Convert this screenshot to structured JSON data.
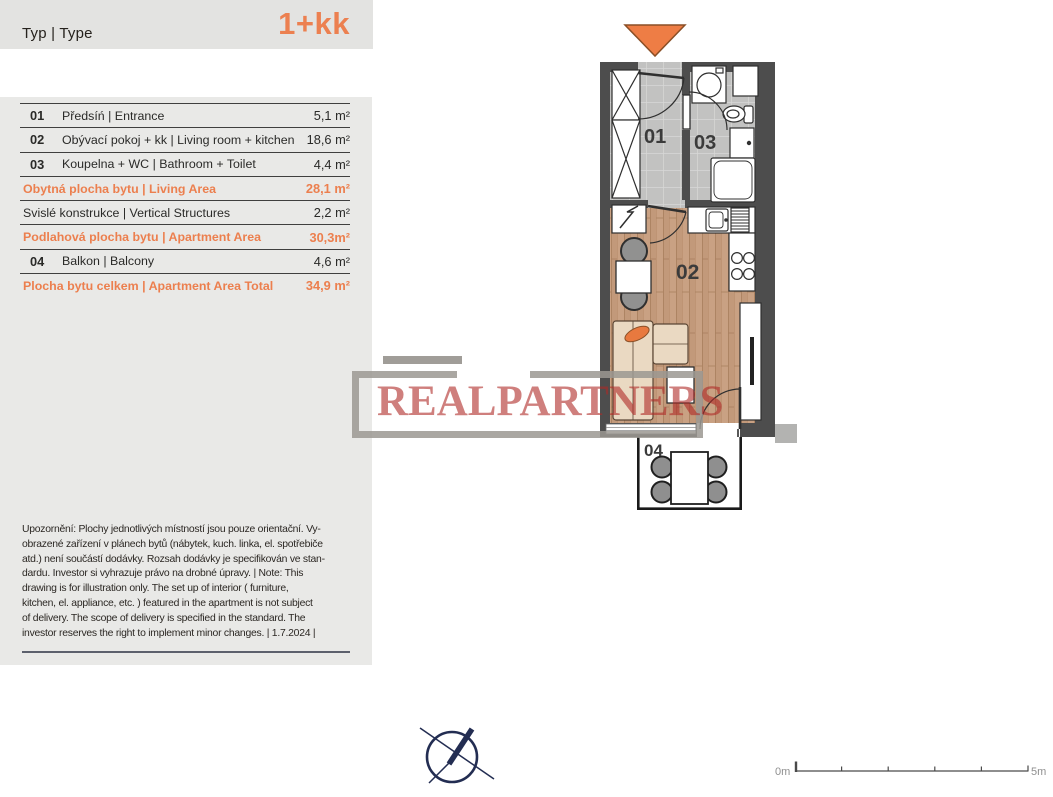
{
  "header": {
    "type_label": "Typ | Type",
    "type_value": "1+kk"
  },
  "colors": {
    "accent_orange": "#ec7f4e",
    "header_bg": "#e3e3e1",
    "panel_bg": "#e9e9e7",
    "wall_gray": "#4d4d4d",
    "wood_floor": "#c9a183",
    "tile_floor": "#c2c2c1",
    "watermark_red": "#af2a26",
    "compass_navy": "#232d52"
  },
  "area_table": {
    "rows": [
      {
        "num": "01",
        "name": "Předsíń | Entrance",
        "area": "5,1 m²",
        "highlight": false
      },
      {
        "num": "02",
        "name": "Obývací pokoj + kk | Living room + kitchen",
        "area": "18,6 m²",
        "highlight": false
      },
      {
        "num": "03",
        "name": "Koupelna + WC | Bathroom + Toilet",
        "area": "4,4 m²",
        "highlight": false
      },
      {
        "num": "",
        "name": "Obytná plocha bytu | Living Area",
        "area": "28,1 m²",
        "highlight": true
      },
      {
        "num": "",
        "name": "Svislé konstrukce | Vertical Structures",
        "area": "2,2 m²",
        "highlight": false
      },
      {
        "num": "",
        "name": "Podlahová plocha bytu | Apartment Area",
        "area": "30,3m²",
        "highlight": true
      },
      {
        "num": "04",
        "name": "Balkon | Balcony",
        "area": "4,6 m²",
        "highlight": false
      },
      {
        "num": "",
        "name": "Plocha bytu celkem | Apartment Area Total",
        "area": "34,9 m²",
        "highlight": true
      }
    ]
  },
  "disclaimer": {
    "lines": [
      "Upozornění: Plochy jednotlivých místností jsou pouze orientační. Vy-",
      "obrazené zařízení v plánech bytů (nábytek, kuch. linka, el. spotřebiče",
      "atd.) není součástí dodávky. Rozsah dodávky je specifikován ve stan-",
      "dardu. Investor si vyhrazuje právo na drobné úpravy. | Note: This",
      "drawing is for illustration only. The set up of interior ( furniture,",
      "kitchen, el. appliance, etc. ) featured in the apartment is not subject",
      "of delivery. The scope of delivery is specified in the standard. The",
      "investor reserves the right to implement minor changes. | 1.7.2024 |"
    ]
  },
  "watermark": {
    "text": "REALPARTNERS"
  },
  "floorplan": {
    "rooms": [
      {
        "id": "01",
        "label": "01"
      },
      {
        "id": "02",
        "label": "02"
      },
      {
        "id": "03",
        "label": "03"
      },
      {
        "id": "04",
        "label": "04"
      }
    ]
  },
  "scalebar": {
    "start_label": "0m",
    "end_label": "5m"
  }
}
